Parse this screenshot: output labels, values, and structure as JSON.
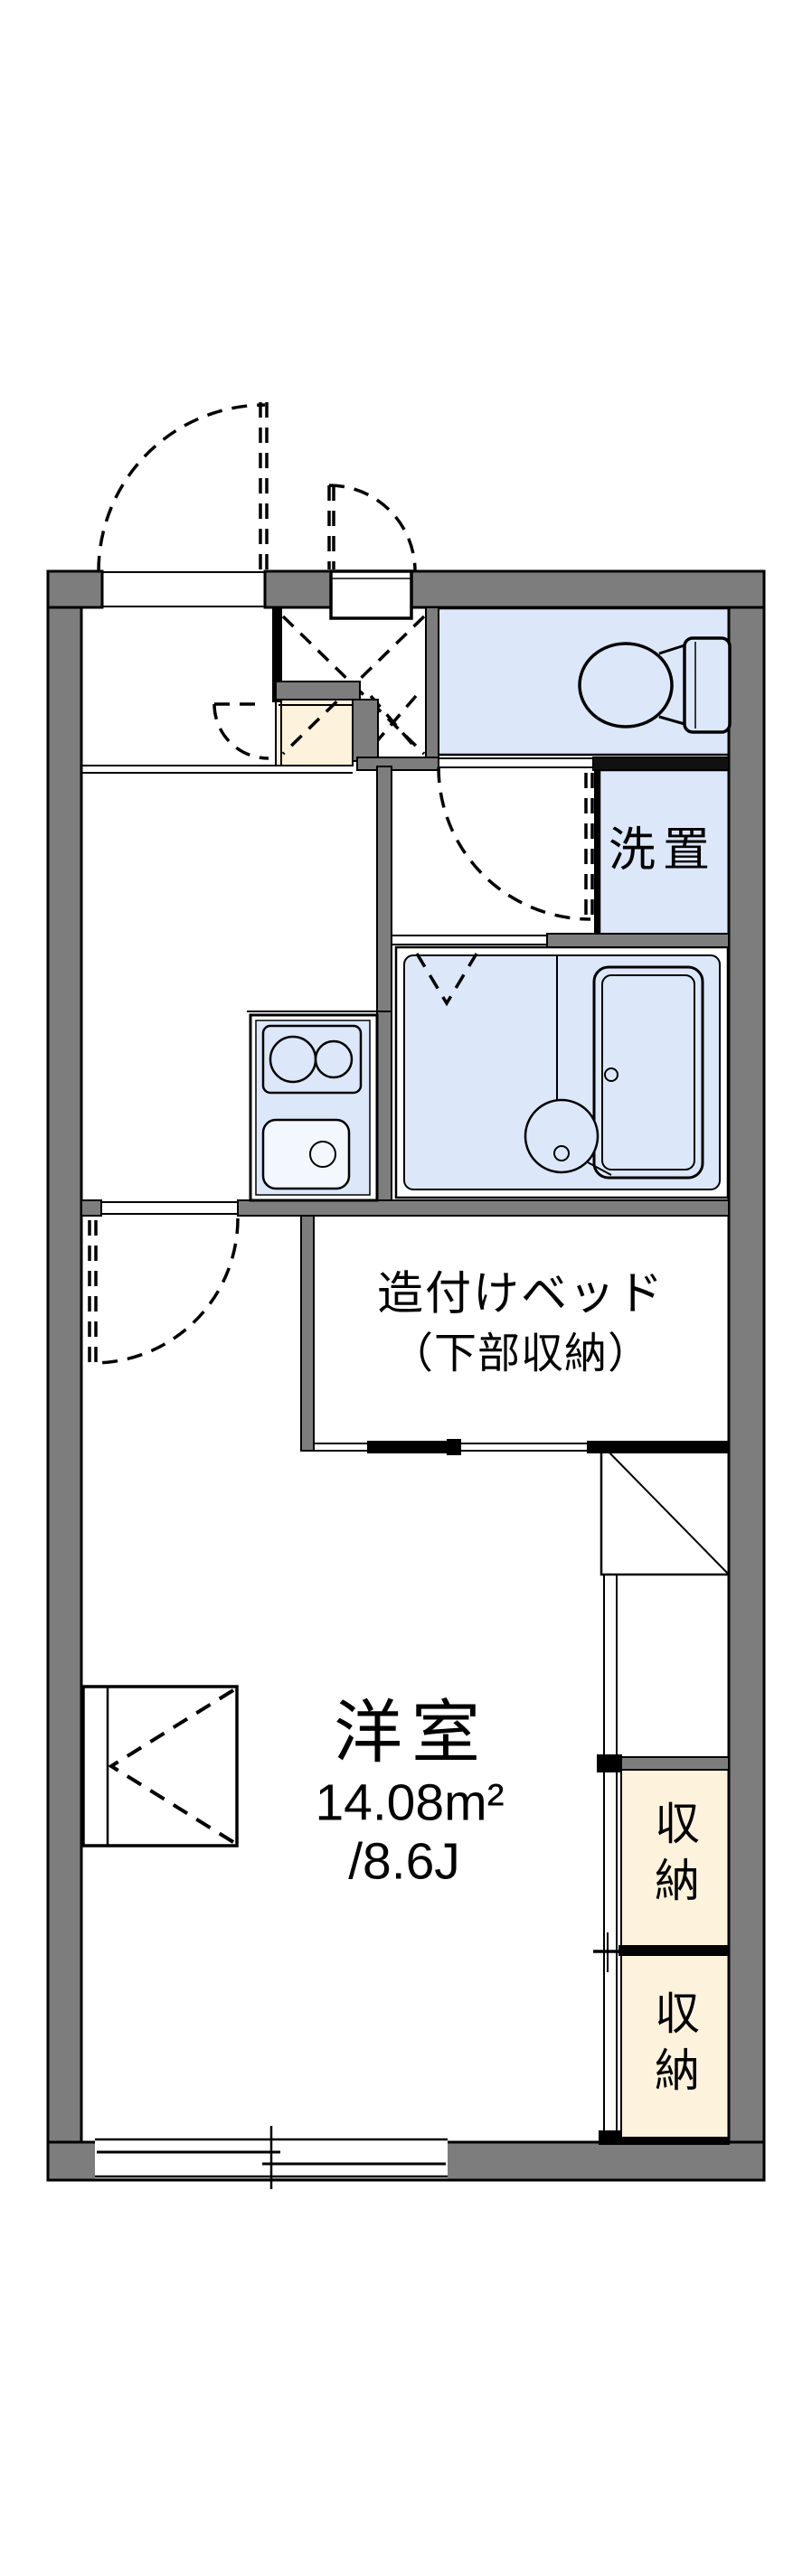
{
  "floorplan": {
    "type": "apartment-1K-floorplan",
    "rooms": {
      "western_room": {
        "name": "洋室",
        "area_sqm": "14.08m²",
        "area_jo": "/8.6J"
      },
      "built_in_bed": {
        "label_line1": "造付けベッド",
        "label_line2": "（下部収納）"
      },
      "washer_space": {
        "label": "洗置"
      },
      "closet_upper": {
        "label": "収納"
      },
      "closet_lower": {
        "label": "収納"
      }
    },
    "colors": {
      "wall_gray": "#7d7d7d",
      "water_area_blue": "#dce8fa",
      "closet_cream": "#fdf2dc",
      "line_black": "#000000",
      "background": "#ffffff"
    }
  }
}
